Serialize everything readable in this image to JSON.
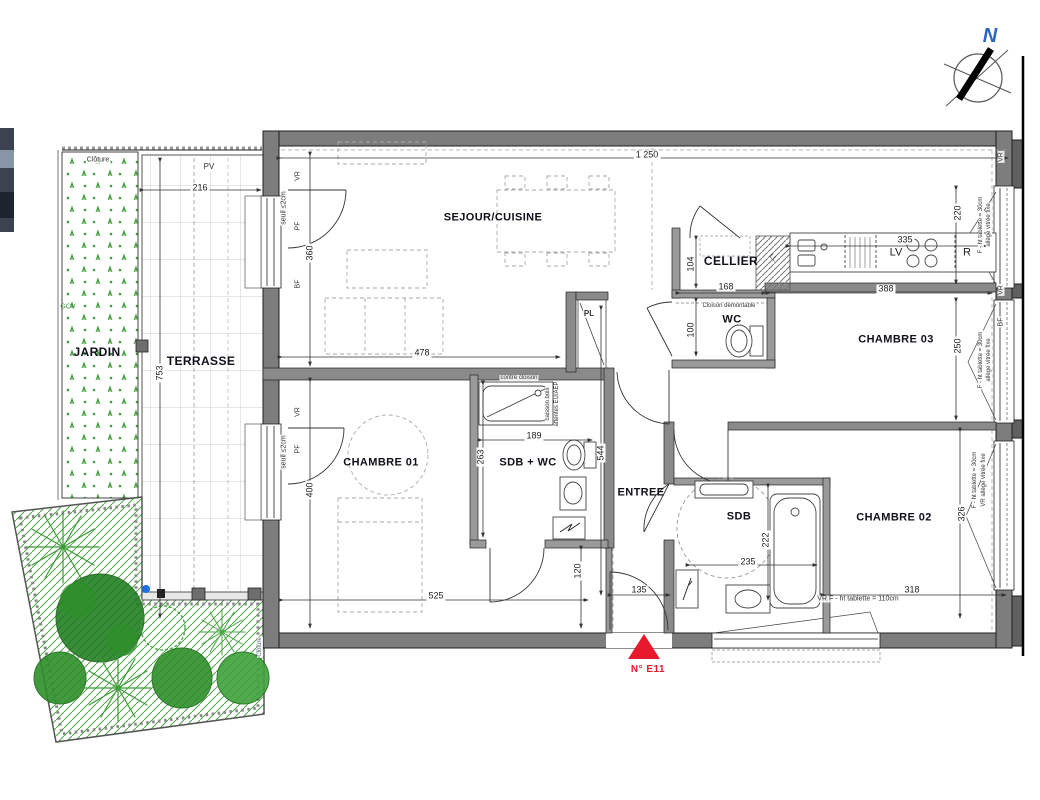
{
  "rooms": [
    "SEJOUR/CUISINE",
    "CELLIER",
    "WC",
    "CHAMBRE 03",
    "CHAMBRE 01",
    "SDB + WC",
    "ENTREE",
    "SDB",
    "CHAMBRE 02",
    "TERRASSE",
    "JARDIN"
  ],
  "dims": [
    "1 250",
    "216",
    "360",
    "478",
    "753",
    "400",
    "525",
    "189",
    "263",
    "544",
    "120",
    "135",
    "104",
    "168",
    "100",
    "335",
    "388",
    "220",
    "250",
    "326",
    "318",
    "235",
    "222"
  ],
  "notes": [
    "VR",
    "PF",
    "BF",
    "seuil ≤2cm",
    "VR",
    "PF",
    "seuil ≤2cm",
    "PL",
    "LV",
    "R",
    "LL",
    "Cloison démontable",
    "contre cloison",
    "caisson bois",
    "attentes EU/AEP",
    "PV",
    "Clôture",
    "Clôture",
    "GCV",
    "VR",
    "F - ht tablette = 30cm",
    "allège vitrée fixe",
    "VR",
    "BF",
    "F - ht tablette = 30cm",
    "allège vitrée fixe",
    "F - ht tablette = 30cm",
    "VR allège vitrée fixe",
    "VR F - ht tablette = 110cm"
  ],
  "compass": {
    "north": "N"
  },
  "lot_marker": {
    "label": "N° E11"
  },
  "colors": {
    "wall": "#7d7d7d",
    "green": "#3f9c3a",
    "red": "#e8192c",
    "blue_dot": "#1f6fe0"
  }
}
